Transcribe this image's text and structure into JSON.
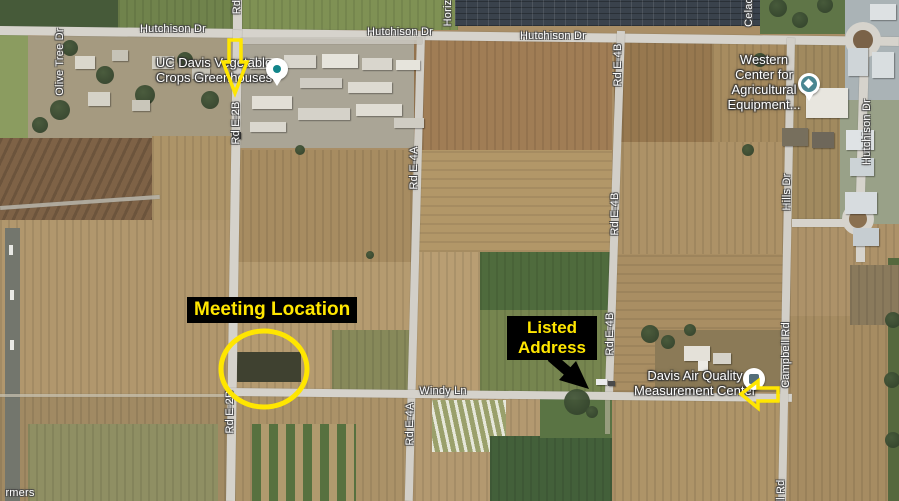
{
  "map": {
    "road_labels": [
      {
        "text": "Hutchison Dr",
        "x": 173,
        "y": 29,
        "vertical": false
      },
      {
        "text": "Hutchison Dr",
        "x": 400,
        "y": 32,
        "vertical": false
      },
      {
        "text": "Hutchison Dr",
        "x": 553,
        "y": 36,
        "vertical": false
      },
      {
        "text": "Hutchison Dr",
        "x": 867,
        "y": 132,
        "vertical": true
      },
      {
        "text": "Olive Tree Dr",
        "x": 60,
        "y": 62,
        "vertical": true
      },
      {
        "text": "Rd",
        "x": 237,
        "y": 7,
        "vertical": true
      },
      {
        "text": "Rd E-2B",
        "x": 236,
        "y": 123,
        "vertical": true
      },
      {
        "text": "Rd E-2B",
        "x": 230,
        "y": 412,
        "vertical": true
      },
      {
        "text": "Rd E-4A",
        "x": 414,
        "y": 168,
        "vertical": true
      },
      {
        "text": "Rd E-4A",
        "x": 410,
        "y": 424,
        "vertical": true
      },
      {
        "text": "Rd E-4B",
        "x": 618,
        "y": 65,
        "vertical": true
      },
      {
        "text": "Rd E-4B",
        "x": 615,
        "y": 214,
        "vertical": true
      },
      {
        "text": "Rd E-4B",
        "x": 610,
        "y": 334,
        "vertical": true
      },
      {
        "text": "Windy Ln",
        "x": 443,
        "y": 391,
        "vertical": false
      },
      {
        "text": "Hills Dr",
        "x": 787,
        "y": 192,
        "vertical": true
      },
      {
        "text": "Campbell Rd",
        "x": 786,
        "y": 355,
        "vertical": true
      },
      {
        "text": "Celad",
        "x": 749,
        "y": 12,
        "vertical": true
      },
      {
        "text": "Horiz",
        "x": 448,
        "y": 13,
        "vertical": true
      },
      {
        "text": "ll Rd",
        "x": 781,
        "y": 491,
        "vertical": true
      },
      {
        "text": "rmers",
        "x": 20,
        "y": 493,
        "vertical": false
      }
    ],
    "poi_labels": [
      {
        "id": "uc-davis-greenhouses",
        "lines": [
          "UC Davis Vegetable",
          "Crops Greenhouses"
        ],
        "x": 214,
        "y": 70,
        "pin": {
          "type": "dot",
          "x": 277,
          "y": 69,
          "color": "#12858a"
        }
      },
      {
        "id": "western-center",
        "lines": [
          "Western",
          "Center for",
          "Agricultural",
          "Equipment..."
        ],
        "x": 764,
        "y": 82,
        "pin": {
          "type": "school",
          "x": 809,
          "y": 84,
          "color": "#4a8691"
        }
      },
      {
        "id": "davis-air-quality",
        "lines": [
          "Davis Air Quality",
          "Measurement Center"
        ],
        "x": 695,
        "y": 383,
        "pin": {
          "type": "gov",
          "x": 754,
          "y": 379,
          "color": "#546e7a"
        }
      }
    ],
    "annotations": {
      "meeting": {
        "label": "Meeting Location",
        "box": {
          "x": 187,
          "y": 297
        },
        "circle": {
          "cx": 264,
          "cy": 369,
          "rx": 43,
          "ry": 38,
          "stroke_width": 5
        }
      },
      "listed": {
        "line1": "Listed",
        "line2": "Address",
        "box": {
          "x": 507,
          "y": 316,
          "w": 80
        },
        "black_arrow": {
          "shaft": {
            "x1": 551,
            "y1": 357,
            "x2": 573,
            "y2": 376,
            "width": 10
          },
          "head_points": "589,389 559,380 576,361"
        }
      },
      "down_arrow_points": "229,40 241,40 241,62 247,62 235,93 223,62 229,62",
      "left_arrow_points": "741,394 758,381 758,388 778,388 778,401 758,401 758,408",
      "colors": {
        "highlight_yellow": "#ffe600",
        "annotation_bg": "#000000",
        "label_white": "#ffffff",
        "black_arrow": "#000000"
      }
    }
  }
}
